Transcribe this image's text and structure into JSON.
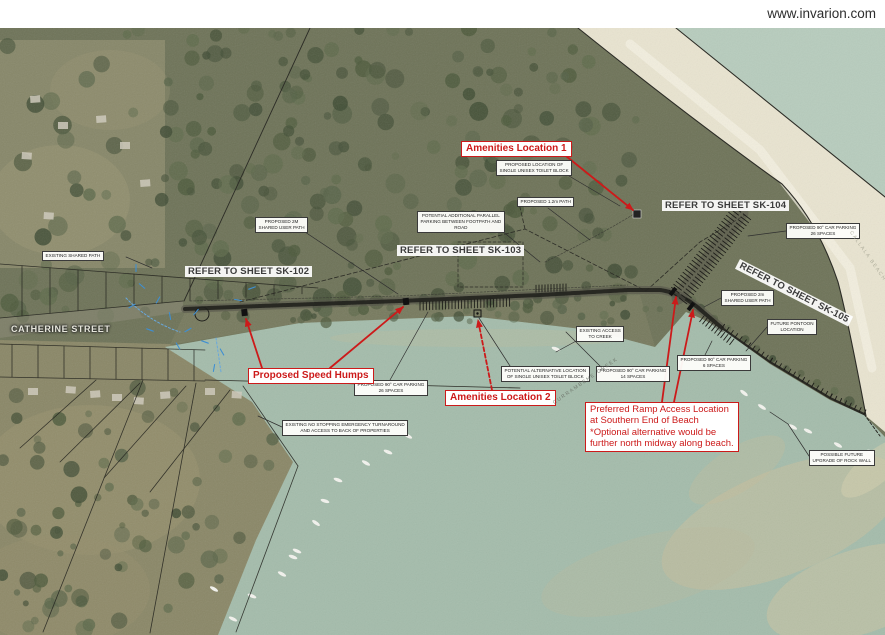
{
  "header": {
    "website": "www.invarion.com"
  },
  "colors": {
    "annotation_red": "#cc1a1a",
    "label_background": "#fdfdfa",
    "creek_water": "#a4bcab",
    "sea_water": "#b7ccbd",
    "beach_sand": "#e9e4d0",
    "forest": "#6e7358"
  },
  "map": {
    "street_label": "CATHERINE STREET",
    "water_labels": [
      {
        "id": "creek-name",
        "text": "CURRAMBENE CREEK",
        "x": 552,
        "y": 401,
        "rot": -35,
        "color": "#6d746a"
      },
      {
        "id": "beach-name",
        "text": "CALLALA BEACH",
        "x": 853,
        "y": 230,
        "rot": 55,
        "color": "#a8a795"
      }
    ],
    "sheet_refs": [
      {
        "id": "refer-sheet-sk102",
        "text": "REFER TO SHEET SK-102",
        "x": 185,
        "y": 266
      },
      {
        "id": "refer-sheet-sk103",
        "text": "REFER TO SHEET SK-103",
        "x": 397,
        "y": 245
      },
      {
        "id": "refer-sheet-sk104",
        "text": "REFER TO SHEET SK-104",
        "x": 662,
        "y": 200
      },
      {
        "id": "refer-sheet-sk105",
        "text": "REFER TO SHEET SK-105",
        "x": 740,
        "y": 259,
        "rot": 27
      }
    ],
    "labels": [
      {
        "id": "existing-shared-path",
        "text": "EXISTING SHARED PATH",
        "x": 42,
        "y": 251,
        "leader": [
          126,
          257,
          152,
          268
        ]
      },
      {
        "id": "proposed-2m-shared-user-path-west",
        "text": "PROPOSED 2M\nSHARED USER PATH",
        "x": 255,
        "y": 217,
        "leader": [
          302,
          230,
          398,
          294
        ]
      },
      {
        "id": "potential-additional-parallel-parking",
        "text": "POTENTIAL ADDITIONAL PARALLEL\nPARKING BETWEEN FOOTPATH AND\nROAD",
        "x": 417,
        "y": 211,
        "leader": [
          496,
          226,
          540,
          262
        ]
      },
      {
        "id": "proposed-1-2m-path",
        "text": "PROPOSED 1.2m PATH",
        "x": 517,
        "y": 197,
        "leader": [
          548,
          208,
          590,
          240
        ]
      },
      {
        "id": "proposed-location-single-unisex-toilet-block",
        "text": "PROPOSED LOCATION OF\nSINGLE UNISEX TOILET BLOCK",
        "x": 496,
        "y": 160,
        "leader": [
          564,
          173,
          620,
          206
        ]
      },
      {
        "id": "proposed-90-car-parking-26-spaces-east",
        "text": "PROPOSED 90° CAR PARKING\n26 SPACES",
        "x": 786,
        "y": 223,
        "leader": [
          786,
          231,
          748,
          236
        ]
      },
      {
        "id": "proposed-2m-shared-user-path-east",
        "text": "PROPOSED 2m\nSHARED USER PATH",
        "x": 721,
        "y": 290,
        "leader": [
          721,
          298,
          704,
          307
        ]
      },
      {
        "id": "future-pontoon-location",
        "text": "FUTURE PONTOON\nLOCATION",
        "x": 767,
        "y": 319,
        "leader": [
          767,
          327,
          746,
          351
        ]
      },
      {
        "id": "existing-access-to-creek",
        "text": "EXISTING ACCESS\nTO CREEK",
        "x": 576,
        "y": 326,
        "leader": [
          578,
          340,
          556,
          352
        ]
      },
      {
        "id": "proposed-90-car-parking-14-spaces",
        "text": "PROPOSED 90° CAR PARKING\n14 SPACES",
        "x": 596,
        "y": 366,
        "leader": [
          600,
          366,
          566,
          332
        ]
      },
      {
        "id": "proposed-90-car-parking-6-spaces",
        "text": "PROPOSED 90° CAR PARKING\n6 SPACES",
        "x": 677,
        "y": 355,
        "leader": [
          705,
          355,
          712,
          341
        ]
      },
      {
        "id": "potential-alternative-toilet-block",
        "text": "POTENTIAL ALTERNATIVE LOCATION\nOF SINGLE UNISEX TOILET BLOCK",
        "x": 501,
        "y": 366,
        "leader": [
          510,
          366,
          479,
          318
        ]
      },
      {
        "id": "proposed-90-car-parking-26-spaces-west",
        "text": "PROPOSED 90° CAR PARKING\n26 SPACES",
        "x": 354,
        "y": 380,
        "leader": [
          390,
          380,
          428,
          312
        ]
      },
      {
        "id": "existing-no-stopping-turnaround",
        "text": "EXISTING NO STOPPING EMERGENCY TURNAROUND\nAND ACCESS TO BACK OF PROPERTIES",
        "x": 282,
        "y": 420,
        "leader": [
          282,
          427,
          258,
          416
        ]
      },
      {
        "id": "possible-future-upgrade-rock-wall",
        "text": "POSSIBLE FUTURE\nUPGRADE OF ROCK WALL",
        "x": 809,
        "y": 450,
        "leader": [
          809,
          456,
          788,
          424,
          770,
          412
        ]
      }
    ],
    "red_annotations": [
      {
        "id": "amenities-location-1",
        "text": "Amenities Location 1",
        "x": 461,
        "y": 141,
        "arrows": [
          [
            566,
            156,
            633,
            210,
            0
          ]
        ]
      },
      {
        "id": "proposed-speed-humps",
        "text": "Proposed Speed Humps",
        "x": 248,
        "y": 368,
        "arrows": [
          [
            262,
            368,
            246,
            319,
            0
          ],
          [
            330,
            368,
            403,
            307,
            0
          ]
        ]
      },
      {
        "id": "amenities-location-2",
        "text": "Amenities Location 2",
        "x": 445,
        "y": 390,
        "arrows": [
          [
            492,
            390,
            478,
            320,
            1
          ]
        ]
      },
      {
        "id": "preferred-ramp-access",
        "align": "left",
        "text": "Preferred Ramp Access Location\nat Southern End of Beach\n*Optional alternative would be\nfurther north midway along beach.",
        "x": 585,
        "y": 402,
        "arrows": [
          [
            662,
            402,
            676,
            297,
            0
          ],
          [
            674,
            402,
            693,
            310,
            0
          ]
        ]
      }
    ],
    "boats": [
      {
        "x": 408,
        "y": 436,
        "r": 28
      },
      {
        "x": 388,
        "y": 452,
        "r": 22
      },
      {
        "x": 366,
        "y": 463,
        "r": 30
      },
      {
        "x": 338,
        "y": 480,
        "r": 20
      },
      {
        "x": 325,
        "y": 501,
        "r": 18
      },
      {
        "x": 316,
        "y": 523,
        "r": 35
      },
      {
        "x": 297,
        "y": 551,
        "r": 24
      },
      {
        "x": 282,
        "y": 574,
        "r": 28
      },
      {
        "x": 252,
        "y": 596,
        "r": 22
      },
      {
        "x": 233,
        "y": 619,
        "r": 26
      },
      {
        "x": 214,
        "y": 589,
        "r": 30
      },
      {
        "x": 293,
        "y": 557,
        "r": 20
      },
      {
        "x": 744,
        "y": 393,
        "r": 38
      },
      {
        "x": 762,
        "y": 407,
        "r": 33
      },
      {
        "x": 793,
        "y": 427,
        "r": 30
      },
      {
        "x": 808,
        "y": 431,
        "r": 26
      },
      {
        "x": 838,
        "y": 445,
        "r": 30
      },
      {
        "x": 871,
        "y": 452,
        "r": 24
      },
      {
        "x": 556,
        "y": 349,
        "r": 20
      }
    ]
  }
}
